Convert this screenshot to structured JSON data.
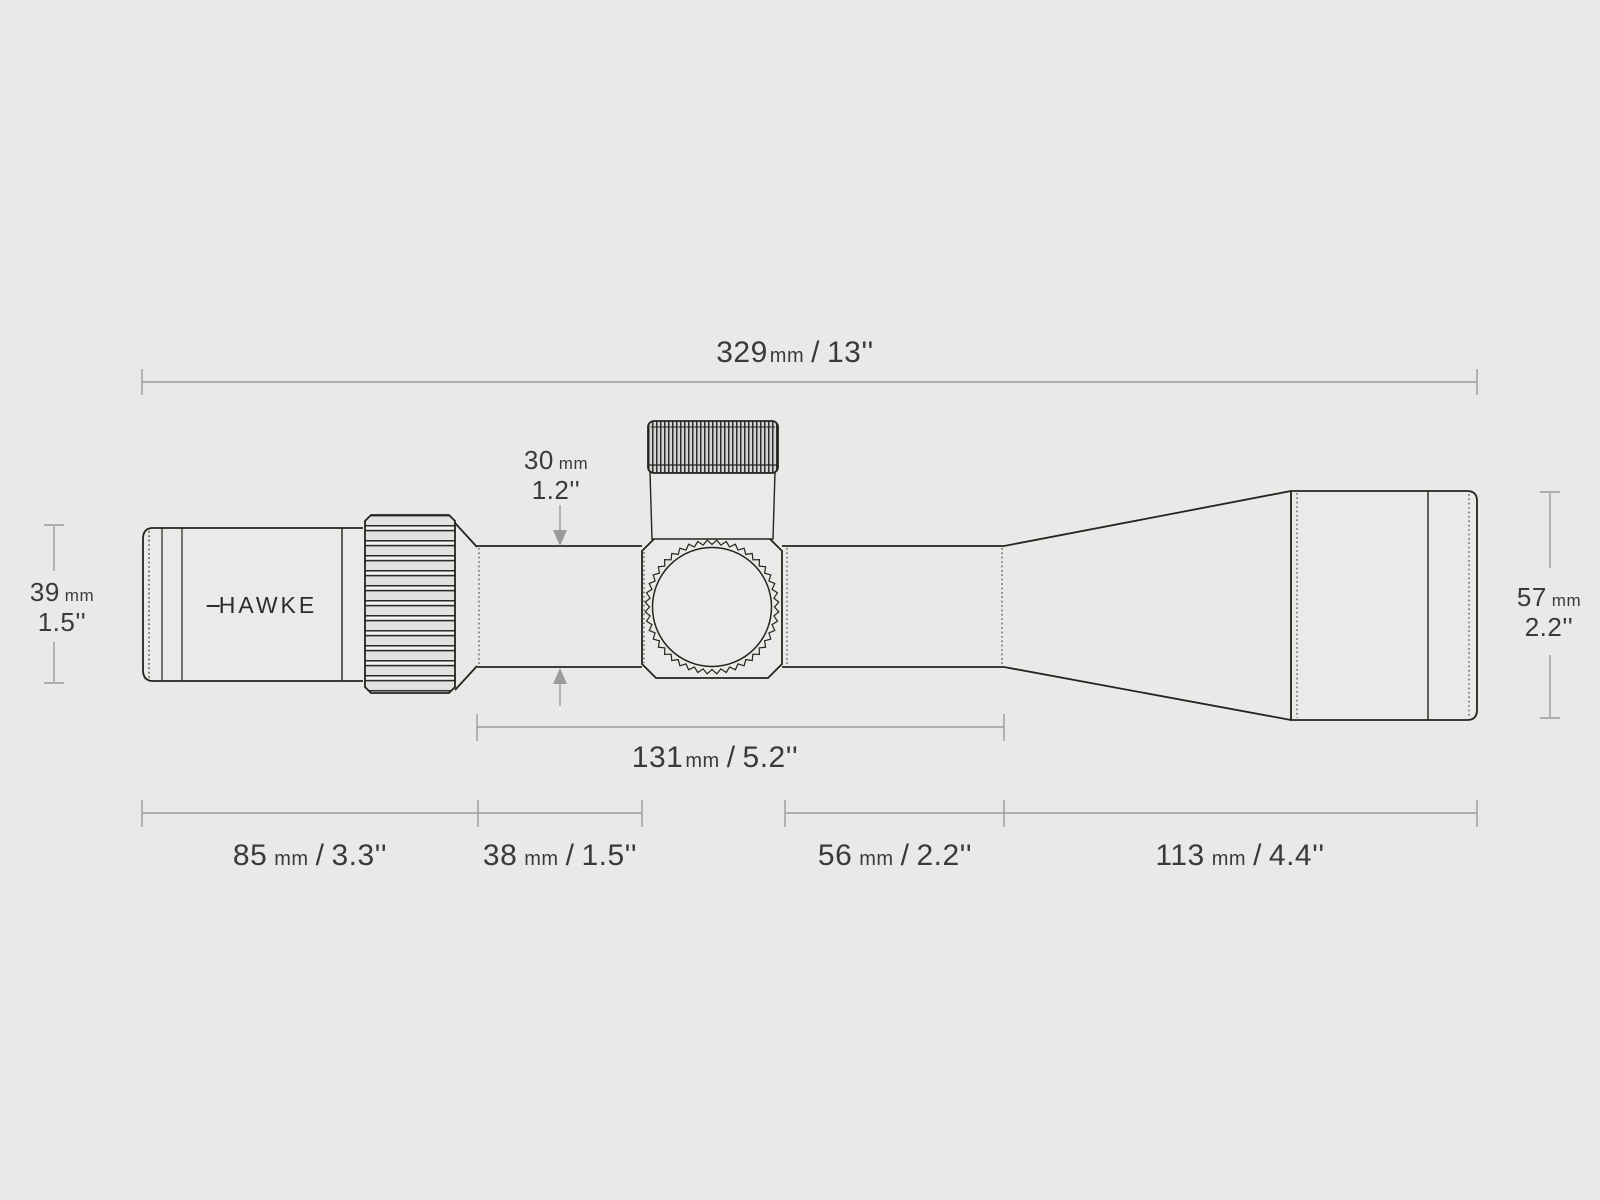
{
  "brand": {
    "logo_text": "HAWKE"
  },
  "colors": {
    "background": "#e9e9e7",
    "outline": "#23231f",
    "dimension_lines": "#9b9b99",
    "label_text": "#3a3a38"
  },
  "dims": {
    "overall_length": {
      "mm": "329",
      "unit": "mm",
      "slash": "/",
      "inches": "13''"
    },
    "eyepiece_diameter": {
      "mm": "39",
      "unit": "mm",
      "inches": "1.5''"
    },
    "tube_diameter": {
      "mm": "30",
      "unit": "mm",
      "inches": "1.2''"
    },
    "objective_diameter": {
      "mm": "57",
      "unit": "mm",
      "inches": "2.2''"
    },
    "mount_space_length": {
      "mm": "131",
      "unit": "mm",
      "slash": "/",
      "inches": "5.2''"
    },
    "eyepiece_length": {
      "mm": "85",
      "unit": "mm",
      "slash": "/",
      "inches": "3.3''"
    },
    "rear_tube_length": {
      "mm": "38",
      "unit": "mm",
      "slash": "/",
      "inches": "1.5''"
    },
    "front_tube_length": {
      "mm": "56",
      "unit": "mm",
      "slash": "/",
      "inches": "2.2''"
    },
    "objective_length": {
      "mm": "113",
      "unit": "mm",
      "slash": "/",
      "inches": "4.4''"
    }
  }
}
